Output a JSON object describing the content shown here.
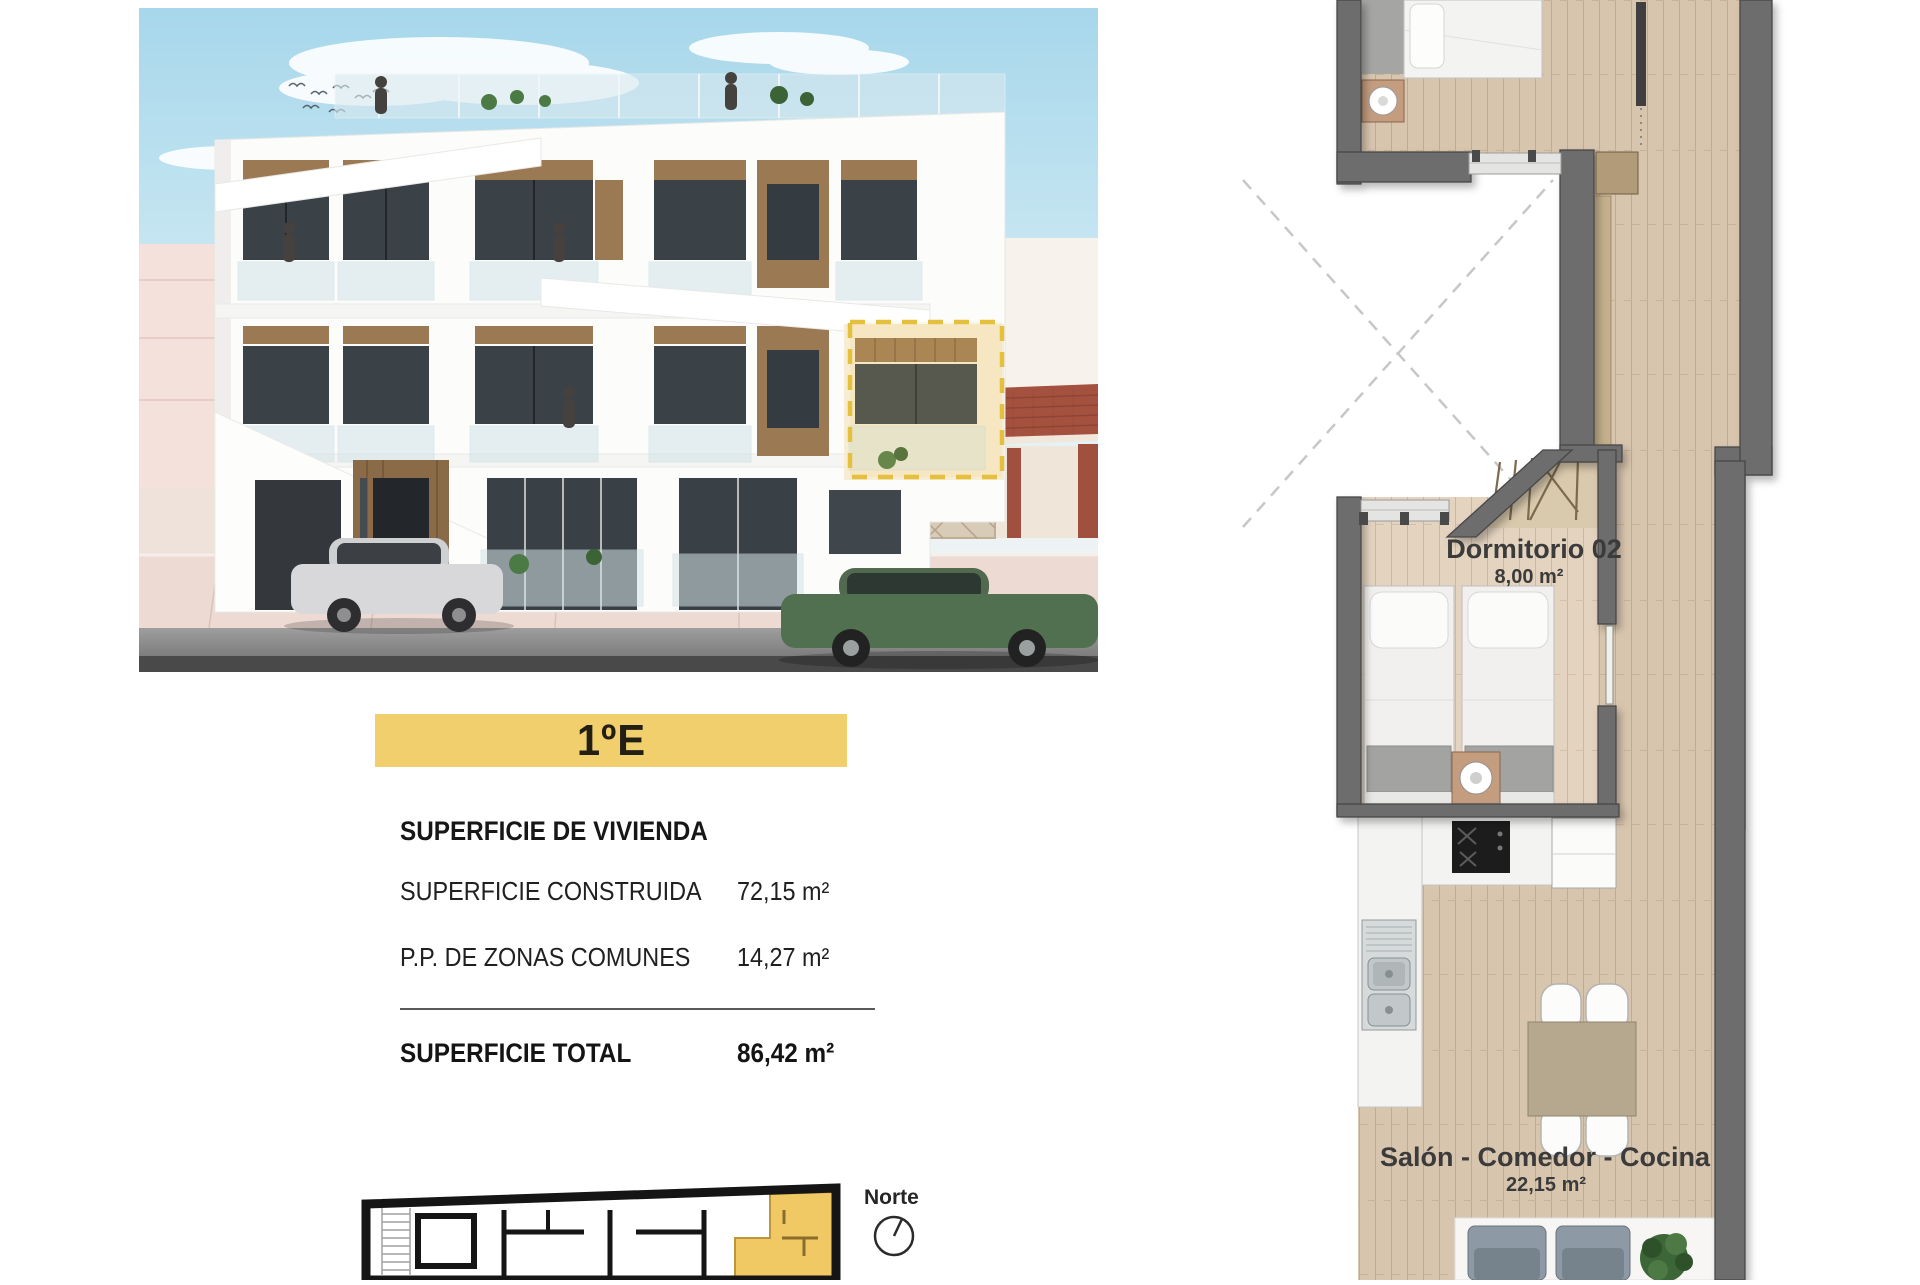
{
  "page": {
    "width": 1920,
    "height": 1280,
    "background": "#ffffff"
  },
  "unit_banner": {
    "label": "1ºE"
  },
  "surface_table": {
    "heading": "SUPERFICIE DE VIVIENDA",
    "rows": [
      {
        "label": "SUPERFICIE CONSTRUIDA",
        "value": "72,15 m²"
      },
      {
        "label": "P.P. DE ZONAS COMUNES",
        "value": "14,27 m²"
      }
    ],
    "total": {
      "label": "SUPERFICIE TOTAL",
      "value": "86,42 m²"
    }
  },
  "key_plan": {
    "compass_label": "Norte"
  },
  "floor_plan": {
    "rooms": [
      {
        "name": "Dormitorio 02",
        "area": "8,00 m²"
      },
      {
        "name": "Salón - Comedor - Cocina",
        "area": "22,15 m²"
      }
    ]
  },
  "colors": {
    "accent_yellow": "#f2cf6d",
    "highlight_dash": "#e5bf3e",
    "wall_gray": "#6d6d6d",
    "wood_floor": "#d8c5ae",
    "sky_blue": "#a7d7eb",
    "text_dark": "#1e1e1e"
  }
}
